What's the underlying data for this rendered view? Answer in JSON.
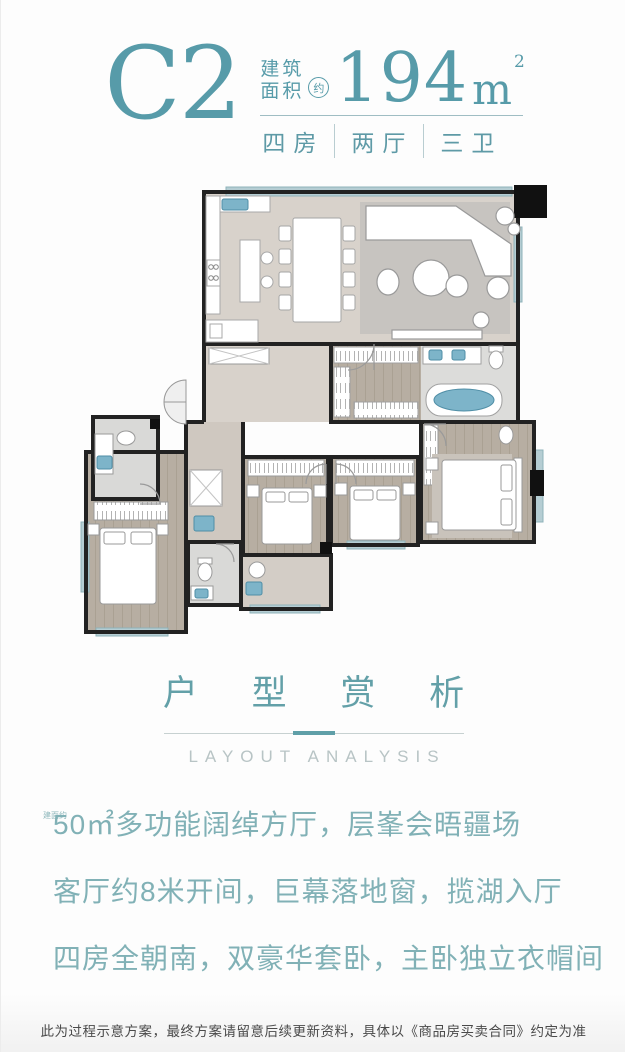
{
  "header": {
    "unit_code": "C2",
    "area_label_line1": "建筑",
    "area_label_line2": "面积",
    "approx": "约",
    "area_value": "194",
    "area_unit": "m",
    "area_exponent": "2",
    "tags": [
      "四房",
      "两厅",
      "三卫"
    ]
  },
  "floor_plan": {
    "name": "unit-c2-floor-plan",
    "rooms": [
      "kitchen",
      "dining-room",
      "living-room",
      "hallway",
      "walk-in-closet",
      "master-bathroom",
      "master-bedroom",
      "bedroom-2",
      "bedroom-3",
      "bedroom-4",
      "ensuite-bathroom",
      "bathroom",
      "terrace"
    ]
  },
  "section": {
    "title": "户 型 赏 析",
    "subtitle": "LAYOUT ANALYSIS"
  },
  "highlights": [
    {
      "prefix": "建面约",
      "text": "50㎡多功能阔绰方厅，层峯会晤疆场"
    },
    {
      "prefix": "",
      "text": "客厅约8米开间，巨幕落地窗，揽湖入厅"
    },
    {
      "prefix": "",
      "text": "四房全朝南，双豪华套卧，主卧独立衣帽间"
    },
    {
      "prefix": "建面约",
      "text": "40㎡尊阔套主卧，约3.9米宽环幕落地窗"
    }
  ],
  "disclaimer": "此为过程示意方案，最终方案请留意后续更新资料，具体以《商品房买卖合同》约定为准",
  "colors": {
    "accent": "#579ba9",
    "body_text": "#81b1b6",
    "subtitle": "#b8c4c5",
    "divider": "#c7d1d1",
    "fixture_teal": "#7db4c9",
    "wall": "#222222",
    "disclaimer": "#4a4a4a"
  }
}
